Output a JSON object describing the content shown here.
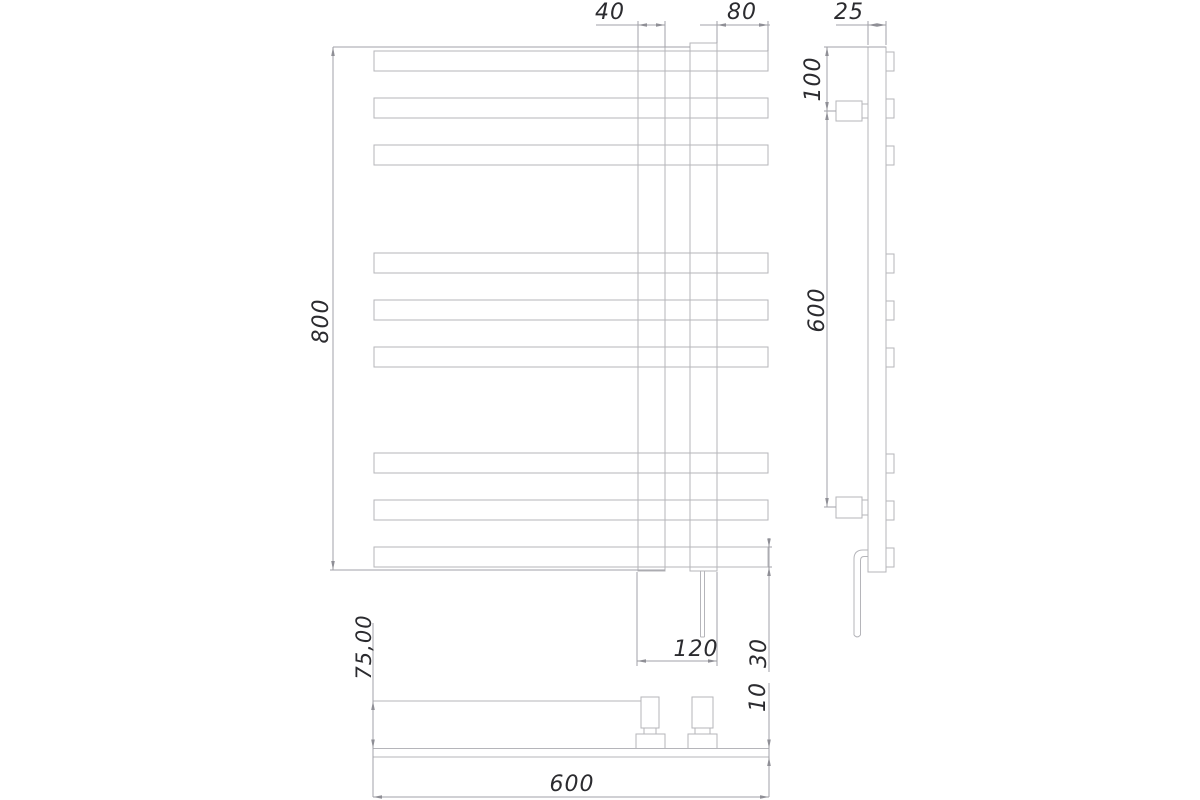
{
  "drawing": {
    "background": "#ffffff",
    "geometry_color": "#b5b5ba",
    "dimension_color": "#a2a2a8",
    "text_color": "#2b2b2f",
    "bar_count": 9,
    "bar_groups": 3
  },
  "dims": {
    "tube_width": "40",
    "right_offset": "80",
    "side_depth": "25",
    "top_bracket_offset": "100",
    "height": "800",
    "bracket_spacing": "600",
    "mount_depth": "75,00",
    "collector_width": "120",
    "bar_height": "30",
    "bar_depth": "10",
    "width": "600"
  }
}
